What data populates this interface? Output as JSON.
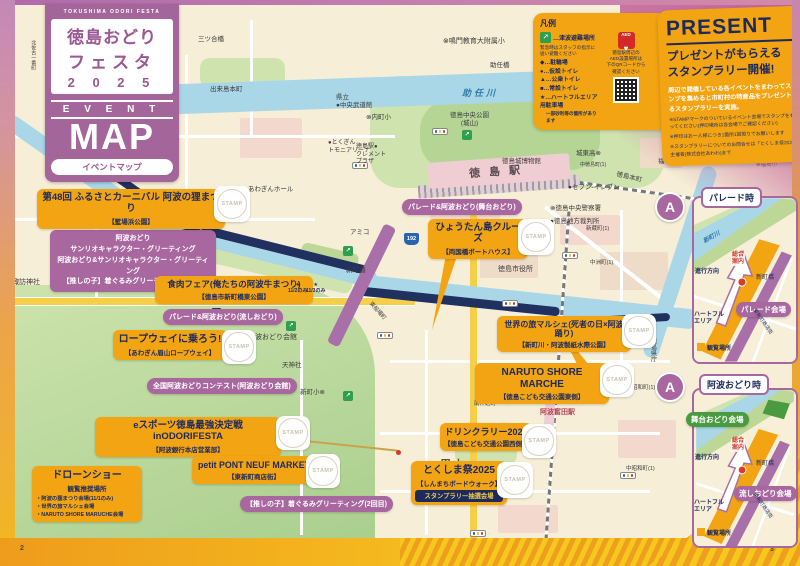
{
  "common": {
    "stamp": "STAMP",
    "page_left": "2",
    "page_right": "3",
    "route": "192",
    "a_mark": "A"
  },
  "title_block": {
    "en": "TOKUSHIMA ODORI FESTA",
    "line1": "徳島おどり",
    "line2": "フェスタ",
    "year": "2 0 2 5",
    "event": "E V E N T",
    "map": "MAP",
    "sub": "イベントマップ"
  },
  "legend": {
    "title": "凡例",
    "tsunami": "…津波避難場所",
    "tsunami_note": "緊急時はスタッフの指示に\n従い避難ください",
    "items": [
      "◆…駐輪場",
      "●…仮設トイレ",
      "▲…公衆トイレ",
      "■…常設トイレ",
      "★…ハートフルエリア用駐車場"
    ],
    "item_note": "一部砂利等の箇所があります",
    "aed": "AED",
    "aed_note": "徳島駅周辺の\nAED設置場所は\n下のQRコードから\n確認ください"
  },
  "present": {
    "title": "PRESENT",
    "headline1": "プレゼントがもらえる",
    "headline2": "スタンプラリー開催!",
    "body": "周辺で開催している各イベントをまわってスタンプを集めると市町村の特産品をプレゼントするスタンプラリーを実施。",
    "notes": [
      "※STAMPマークのついているイベント会場でスタンプをもらってください(押印場所は各会場でご確認ください)",
      "※押印はお一人様につき1箇所1回限りでお願いします",
      "※スタンプラリーについてのお問合せは「とくしま祭2025」主催者(株式会社あわわ)まで"
    ]
  },
  "events": [
    {
      "title": "第48回 ふるさとカーニバル 阿波の狸まつり",
      "venue": "【藍場浜公園】"
    },
    {
      "lines": [
        "阿波おどり",
        "サンリオキャラクター・グリーティング",
        "阿波おどり&サンリオキャラクター・グリーティング",
        "【推しの子】着ぐるみグリーティング(1回目)"
      ]
    },
    {
      "title": "食肉フェア(俺たちの阿波牛まつり)",
      "venue": "【徳島市新町橋東公園】"
    },
    {
      "title": "パレード&阿波おどり(流しおどり)"
    },
    {
      "title": "ロープウェイに乗ろう!",
      "venue": "【あわぎん眉山ロープウェイ】"
    },
    {
      "title": "全国阿波おどりコンテスト(阿波おどり会館)"
    },
    {
      "title": "eスポーツ徳島最強決定戦inODORIFESTA",
      "venue": "【阿波銀行本店営業部】"
    },
    {
      "title": "petit PONT NEUF MARKET",
      "venue": "【東新町商店街】"
    },
    {
      "title": "【推しの子】着ぐるみグリーティング(2回目)"
    },
    {
      "title": "ドローンショー",
      "sub": "観覧推奨場所",
      "bullets": [
        "・阿波の狸まつり会場(11/1のみ)",
        "・世界の旅マルシェ会場",
        "・NARUTO SHORE MARUCHE会場"
      ]
    },
    {
      "title": "ひょうたん島クルーズ",
      "venue": "【両国橋ボートハウス】"
    },
    {
      "title": "パレード&阿波おどり(舞台おどり)"
    },
    {
      "title": "世界の旅マルシェ(死者の日×阿波踊り)",
      "venue": "【新町川・阿波製紙水際公園】"
    },
    {
      "title": "NARUTO SHORE MARCHE",
      "venue": "【徳島こども交通公園東側】"
    },
    {
      "title": "ドリンクラリー2025",
      "venue": "【徳島こども交通公園西側】"
    },
    {
      "title": "とくしま祭2025",
      "venue": "【しんまちボードウォーク】",
      "badge": "スタンプラリー抽選会場"
    }
  ],
  "note_dates": {
    "d1": "★\n11/2のみ",
    "d2": "★\n11/3のみ"
  },
  "insets": {
    "parade": {
      "header": "パレード時",
      "river": "新町川",
      "direction": "進行方向",
      "info": "総合\n案内",
      "bridge": "新町橋",
      "venue": "パレード会場",
      "heartful": "ハートフル\nエリア",
      "viewing": "観覧場所",
      "street": "東新町商店街"
    },
    "awaodori": {
      "header": "阿波おどり時",
      "stage": "舞台おどり会場",
      "direction": "進行方向",
      "info": "総合\n案内",
      "bridge": "新町橋",
      "nagashi": "流しおどり会場",
      "heartful": "ハートフル\nエリア",
      "viewing": "観覧場所",
      "street": "東新町商店街"
    }
  },
  "map": {
    "labels": {
      "sako_sta": "佐古駅",
      "kitasako": "北佐古一番町",
      "mitsuai": "三ツ合橋",
      "dekijima": "出来島本町",
      "naruto_es": "⊗鳴門教育大附属小",
      "suketo_br": "助任橋",
      "suketo_riv": "助任川",
      "budokan": "県立\n●中央武道館",
      "uchimachi": "⊗内町小",
      "chuo_koen": "徳島中央公園\n(城山)",
      "johaku": "徳島城博物館",
      "station": "徳島駅",
      "clement": "徳島駅●\nクレメント\nプラザ",
      "awagin_hall": "●あわぎんホール",
      "tokugin": "●とくぎん\nトモニアリーナ",
      "amiko": "アミコ",
      "joto": "城東高⊗",
      "nakatoku": "中徳島町(1)",
      "seven": "●セブン-イレブン",
      "fukushima_br": "福島橋",
      "fukushima_es": "⊗福島小",
      "honcho": "徳島本町",
      "police": "⊗徳島中央警察署",
      "court": "●徳島地方裁判所",
      "cityhall": "徳島市役所",
      "shinmachi_br": "新町橋",
      "funaba": "東船場町",
      "odori_kaikan": "阿波おどり会館",
      "tenjin": "天神社",
      "shinmachi_es": "新町小⊗",
      "bizan": "眉山",
      "awatomida": "阿波富田駅",
      "minaminaka": "南仲之町",
      "showa": "昭和町(1)",
      "nakashowa": "中昭和町(1)",
      "shinzo": "新蔵町(1)",
      "nakasu": "中洲町(1)",
      "kencho": "徳島県庁",
      "suwa": "諏訪神社",
      "sako_ohashi": "佐古大橋"
    }
  }
}
